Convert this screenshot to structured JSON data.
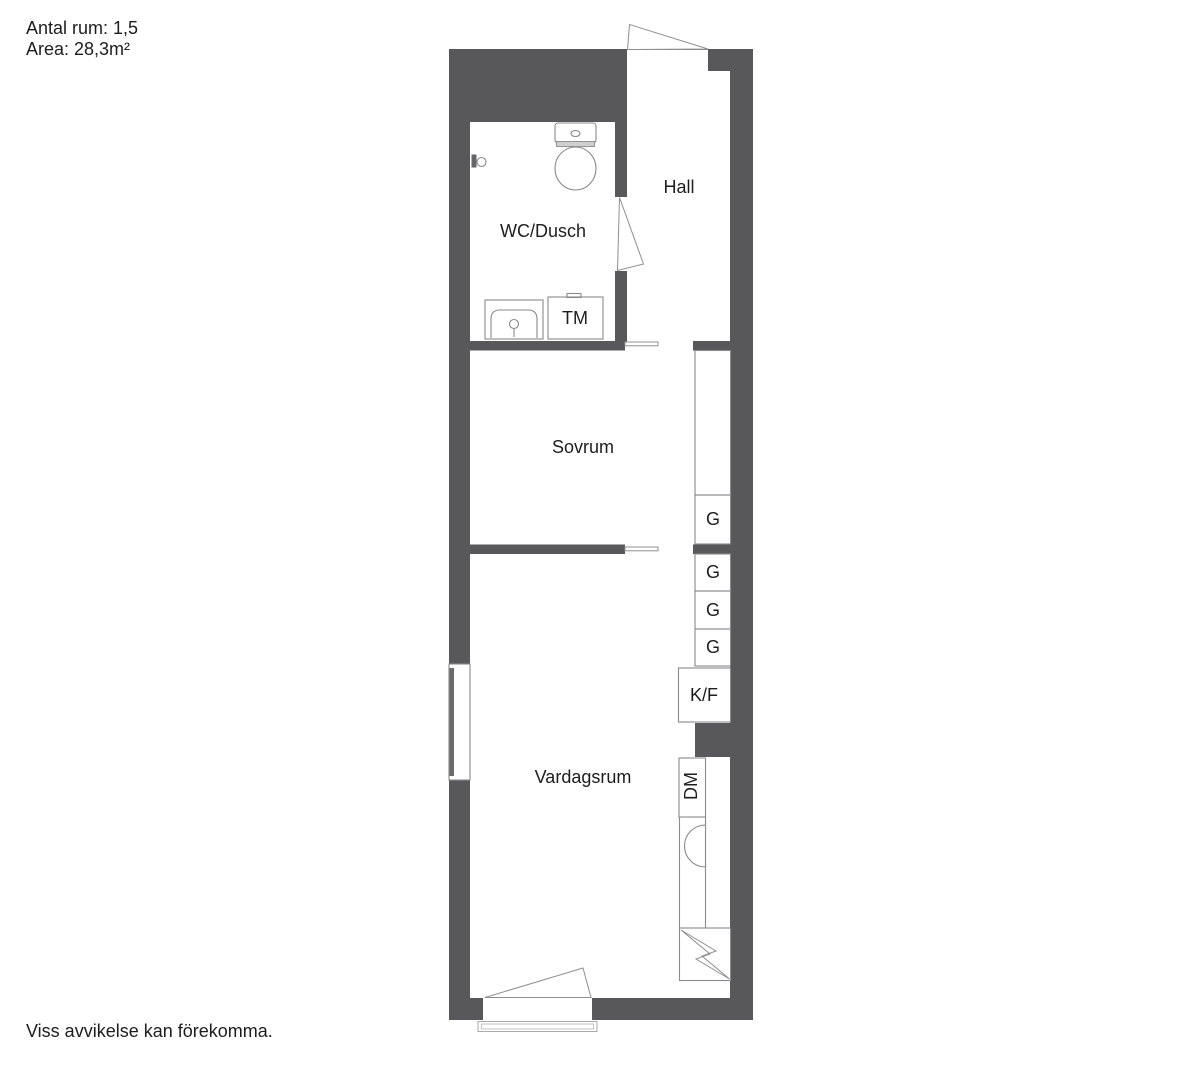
{
  "info": {
    "rooms_line": "Antal rum: 1,5",
    "area_line": "Area: 28,3m²"
  },
  "disclaimer": "Viss avvikelse kan förekomma.",
  "rooms": {
    "hall": {
      "label": "Hall"
    },
    "wc_dusch": {
      "label": "WC/Dusch"
    },
    "sovrum": {
      "label": "Sovrum"
    },
    "vardagsrum": {
      "label": "Vardagsrum"
    }
  },
  "fixtures": {
    "tm": {
      "label": "TM",
      "name": "washing-machine"
    },
    "kf": {
      "label": "K/F",
      "name": "fridge-freezer"
    },
    "dm": {
      "label": "DM",
      "name": "dishwasher"
    }
  },
  "closets": [
    {
      "label": "G"
    },
    {
      "label": "G"
    },
    {
      "label": "G"
    },
    {
      "label": "G"
    }
  ],
  "icons": [
    "toilet-icon",
    "bathroom-sink-icon",
    "shower-mixer-icon",
    "kitchen-sink-icon",
    "stove-zigzag-icon",
    "window-icon",
    "sliding-door-icon",
    "door-swing-icon",
    "balcony-threshold-icon"
  ],
  "colors": {
    "wall": "#58585a",
    "line": "#8a8a8a",
    "text": "#1d1d1d",
    "background": "#ffffff"
  }
}
